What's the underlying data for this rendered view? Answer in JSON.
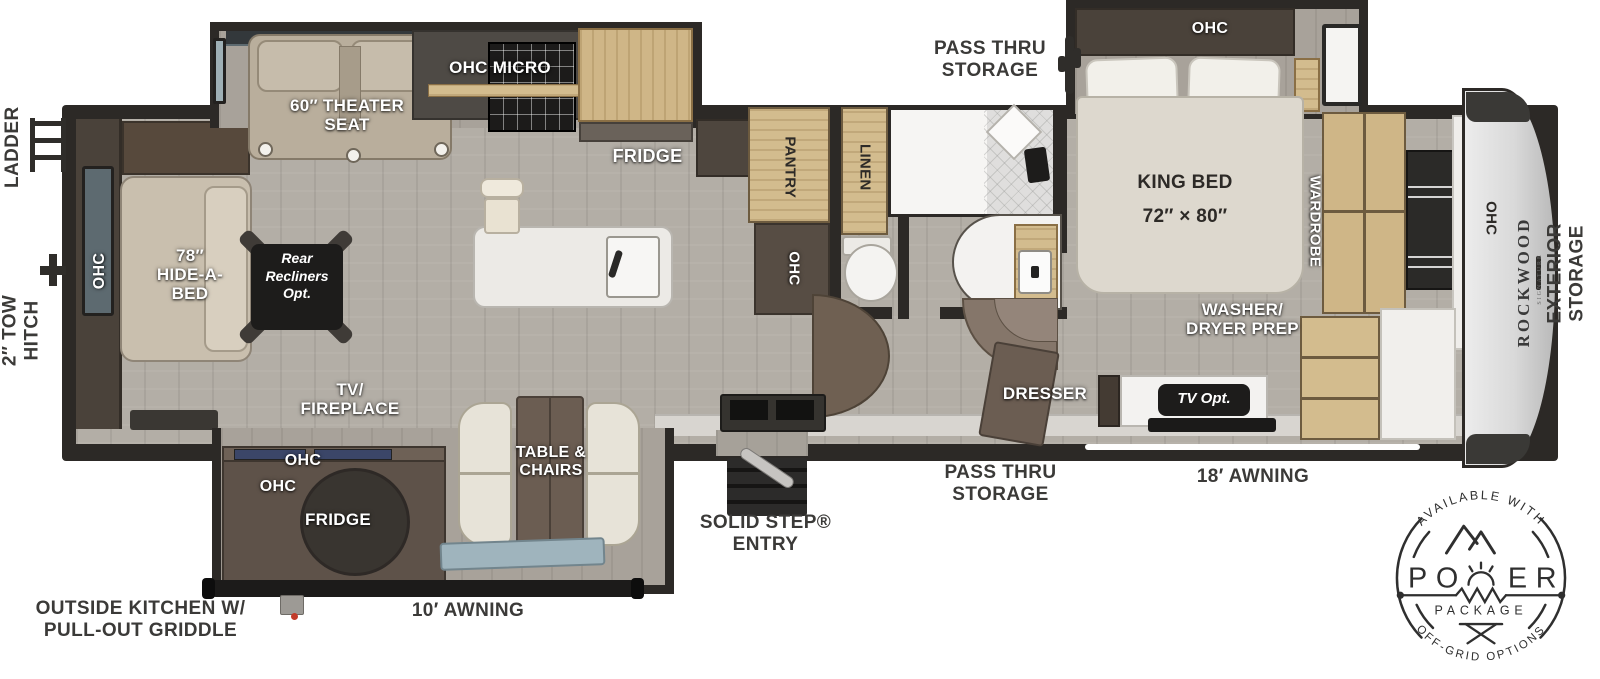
{
  "plan_labels": {
    "ladder": "LADDER",
    "tow_hitch": "2″ TOW\nHITCH",
    "pass_thru_top": "PASS THRU\nSTORAGE",
    "pass_thru_bottom": "PASS THRU\nSTORAGE",
    "awning_18": "18′ AWNING",
    "awning_10": "10′ AWNING",
    "solid_step_entry": "SOLID STEP®\nENTRY",
    "outside_kitchen": "OUTSIDE KITCHEN W/\nPULL-OUT GRIDDLE",
    "exterior_storage": "EXTERIOR\nSTORAGE"
  },
  "living_room": {
    "theater_seat": "60″ THEATER\nSEAT",
    "ohc_micro": "OHC MICRO",
    "fridge": "FRIDGE",
    "rear_ohc": "OHC",
    "hide_a_bed": "78″\nHIDE-A-\nBED",
    "rear_recliners": "Rear\nRecliners\nOpt.",
    "tv_fireplace": "TV/\nFIREPLACE",
    "outside_ohc_1": "OHC",
    "outside_ohc_2": "OHC",
    "outside_fridge": "FRIDGE",
    "table_chairs": "TABLE &\nCHAIRS"
  },
  "bathroom": {
    "pantry": "PANTRY",
    "ohc": "OHC",
    "linen": "LINEN"
  },
  "bedroom": {
    "ohc": "OHC",
    "king_bed": "KING BED\n72″ × 80″",
    "wardrobe": "WARDROBE",
    "washer_dryer_prep": "WASHER/\nDRYER PREP",
    "dresser": "DRESSER",
    "tv_opt": "TV Opt.",
    "front_ohc": "OHC"
  },
  "front_cap": {
    "brand": "ROCKWOOD",
    "series": "SIGNATURE"
  },
  "power_badge": {
    "top_arc": "AVAILABLE WITH",
    "power_left": "PO",
    "power_right": "ER",
    "package": "PACKAGE",
    "bottom_arc": "OFF-GRID OPTIONS"
  },
  "colors": {
    "wall": "#2c2926",
    "floor": "#b3aea6",
    "cabinet_wood": "#d3bc8e",
    "label_white": "#ffffff",
    "label_dark": "#3b3a38"
  }
}
